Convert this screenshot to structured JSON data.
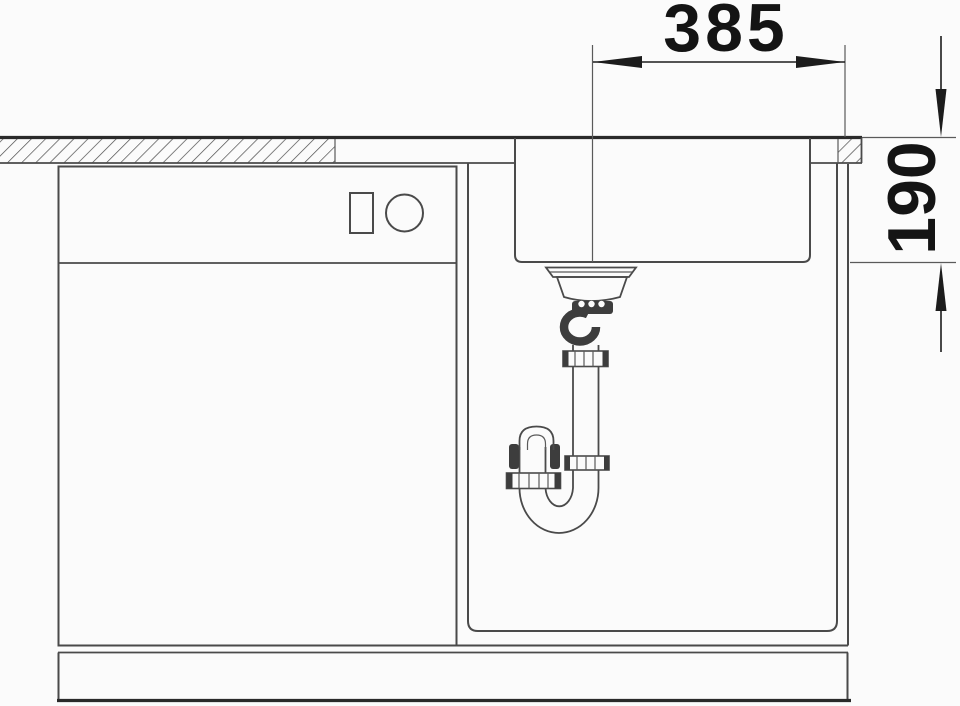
{
  "figure": {
    "type": "technical-installation-drawing",
    "background_color": "#fbfbfb",
    "line_color": "#4a4a4a",
    "emphasis_line_color": "#2a2a2a",
    "dimension_text_color": "#141414",
    "dimensions": {
      "horizontal_label": "385",
      "vertical_label": "190"
    }
  }
}
